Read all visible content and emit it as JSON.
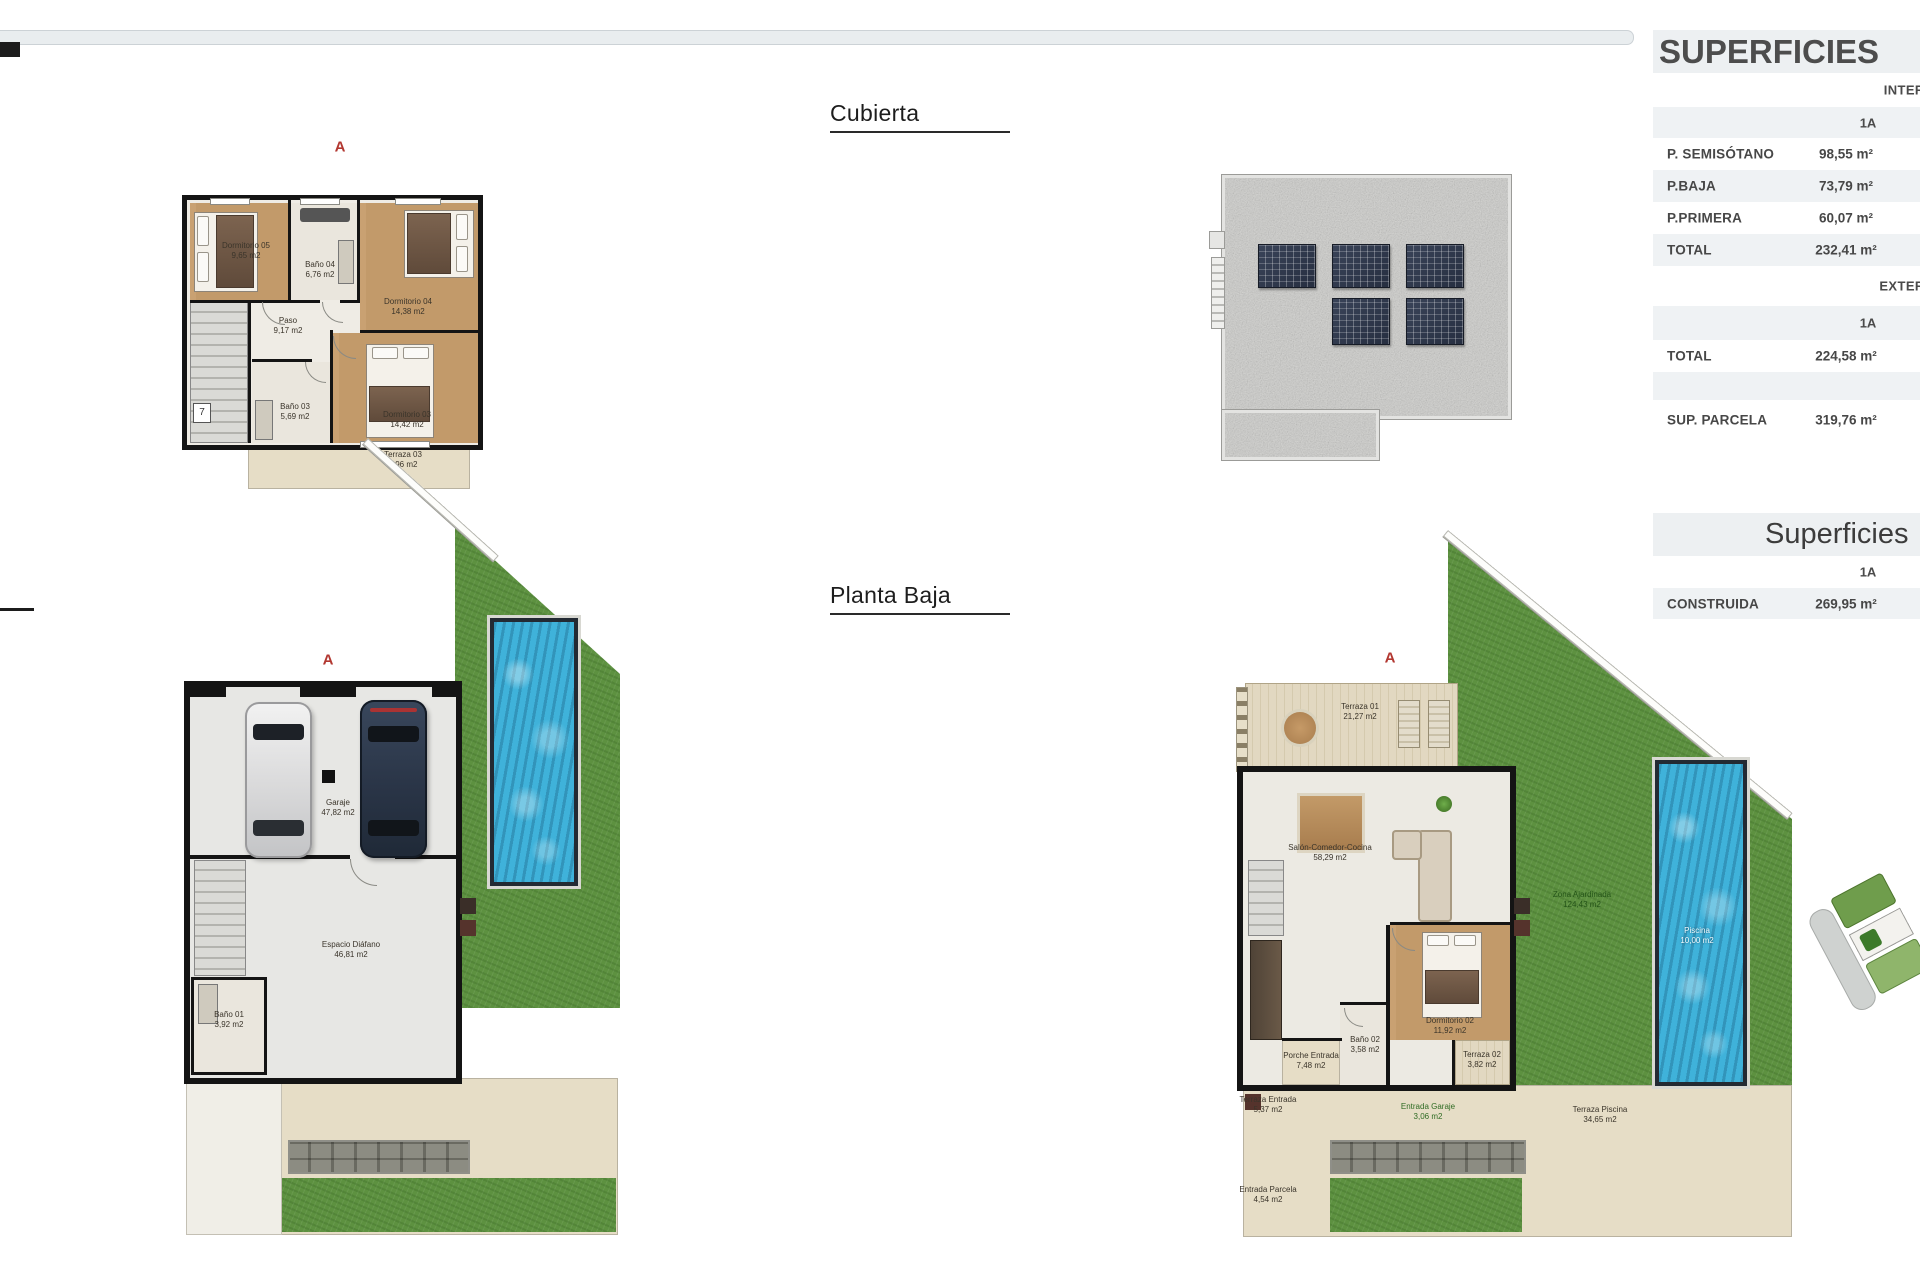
{
  "page": {
    "kind": "architectural plan sheet",
    "accent_red": "#b23730",
    "grass_green": "#5d9140",
    "pool_blue": "#3fb2da",
    "table_grey": "#eff2f4"
  },
  "titles": {
    "cubierta": "Cubierta",
    "planta_baja": "Planta Baja"
  },
  "tables": {
    "superficies": {
      "title": "SUPERFICIES",
      "interior_header": "INTERIOR",
      "interior_unit": "1A",
      "rows_interior": [
        {
          "label": "P. SEMISÓTANO",
          "value": "98,55 m²"
        },
        {
          "label": "P.BAJA",
          "value": "73,79 m²"
        },
        {
          "label": "P.PRIMERA",
          "value": "60,07 m²"
        },
        {
          "label": "TOTAL",
          "value": "232,41 m²"
        }
      ],
      "exterior_header": "EXTERIOR",
      "exterior_unit": "1A",
      "rows_exterior": [
        {
          "label": "TOTAL",
          "value": "224,58 m²"
        }
      ],
      "parcela": {
        "label": "SUP. PARCELA",
        "value": "319,76 m²"
      }
    },
    "construida": {
      "title": "Superficies",
      "unit": "1A",
      "row": {
        "label": "CONSTRUIDA",
        "value": "269,95 m²"
      }
    }
  },
  "plans": {
    "primera": {
      "marker": "A",
      "stair_label": "7",
      "rooms": [
        {
          "name": "Dormitorio 05",
          "area": "9,65 m2"
        },
        {
          "name": "Baño 04",
          "area": "6,76 m2"
        },
        {
          "name": "Dormitorio 04",
          "area": "14,38 m2"
        },
        {
          "name": "Paso",
          "area": "9,17 m2"
        },
        {
          "name": "Baño 03",
          "area": "5,69 m2"
        },
        {
          "name": "Dormitorio 03",
          "area": "14,42 m2"
        },
        {
          "name": "Terraza 03",
          "area": "9,96 m2"
        }
      ]
    },
    "semisotano": {
      "marker": "A",
      "rooms": [
        {
          "name": "Garaje",
          "area": "47,82 m2"
        },
        {
          "name": "Baño 01",
          "area": "3,92 m2"
        },
        {
          "name": "Espacio Diáfano",
          "area": "46,81 m2"
        }
      ]
    },
    "baja": {
      "marker": "A",
      "rooms": [
        {
          "name": "Terraza 01",
          "area": "21,27 m2"
        },
        {
          "name": "Salón-Comedor-Cocina",
          "area": "58,29 m2"
        },
        {
          "name": "Dormitorio 02",
          "area": "11,92 m2"
        },
        {
          "name": "Baño 02",
          "area": "3,58 m2"
        },
        {
          "name": "Terraza 02",
          "area": "3,82 m2"
        },
        {
          "name": "Porche Entrada",
          "area": "7,48 m2"
        },
        {
          "name": "Terraza Entrada",
          "area": "5,37 m2"
        },
        {
          "name": "Entrada Parcela",
          "area": "4,54 m2"
        },
        {
          "name": "Entrada Garaje",
          "area": "3,06 m2"
        },
        {
          "name": "Terraza Piscina",
          "area": "34,65 m2"
        },
        {
          "name": "Zona Ajardinada",
          "area": "124,43 m2"
        },
        {
          "name": "Piscina",
          "area": "10,00 m2"
        }
      ]
    }
  }
}
